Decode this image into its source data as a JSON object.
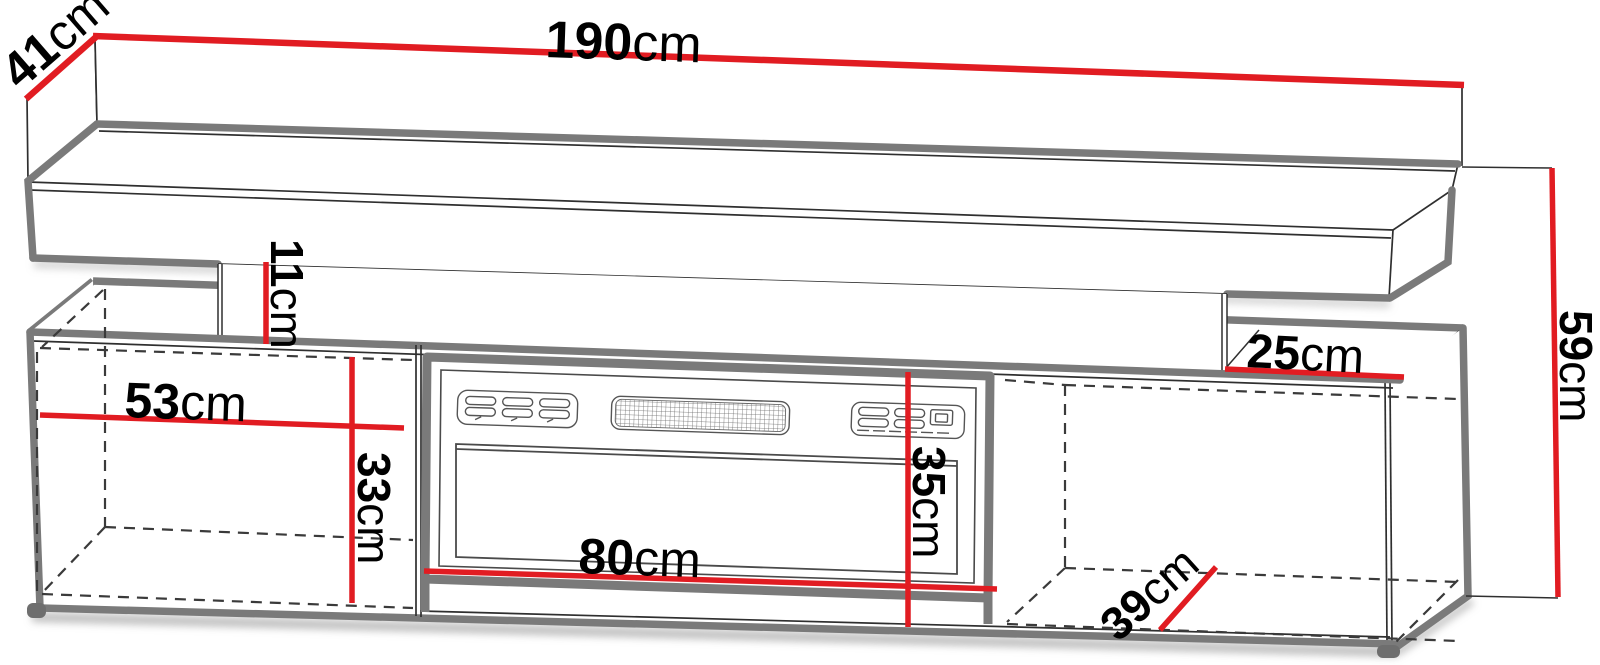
{
  "diagram": {
    "type": "furniture-dimension-drawing",
    "subject": "TV stand with electric fireplace insert and floating wall shelf",
    "unit": "cm",
    "colors": {
      "dimension_line": "#e11c22",
      "outline_thick": "#7a7a7a",
      "outline_thin": "#2f2f2f",
      "hidden_edge": "#3a3a3a",
      "background": "#ffffff"
    },
    "dimensions": {
      "total_width": {
        "value": "190",
        "unit": "cm"
      },
      "top_depth": {
        "value": "41",
        "unit": "cm"
      },
      "shelf_gap_height": {
        "value": "11",
        "unit": "cm"
      },
      "left_compartment_width": {
        "value": "53",
        "unit": "cm"
      },
      "left_compartment_height": {
        "value": "33",
        "unit": "cm"
      },
      "fireplace_width": {
        "value": "80",
        "unit": "cm"
      },
      "fireplace_height": {
        "value": "35",
        "unit": "cm"
      },
      "right_top_depth": {
        "value": "25",
        "unit": "cm"
      },
      "total_height": {
        "value": "59",
        "unit": "cm"
      },
      "bottom_depth": {
        "value": "39",
        "unit": "cm"
      }
    }
  }
}
